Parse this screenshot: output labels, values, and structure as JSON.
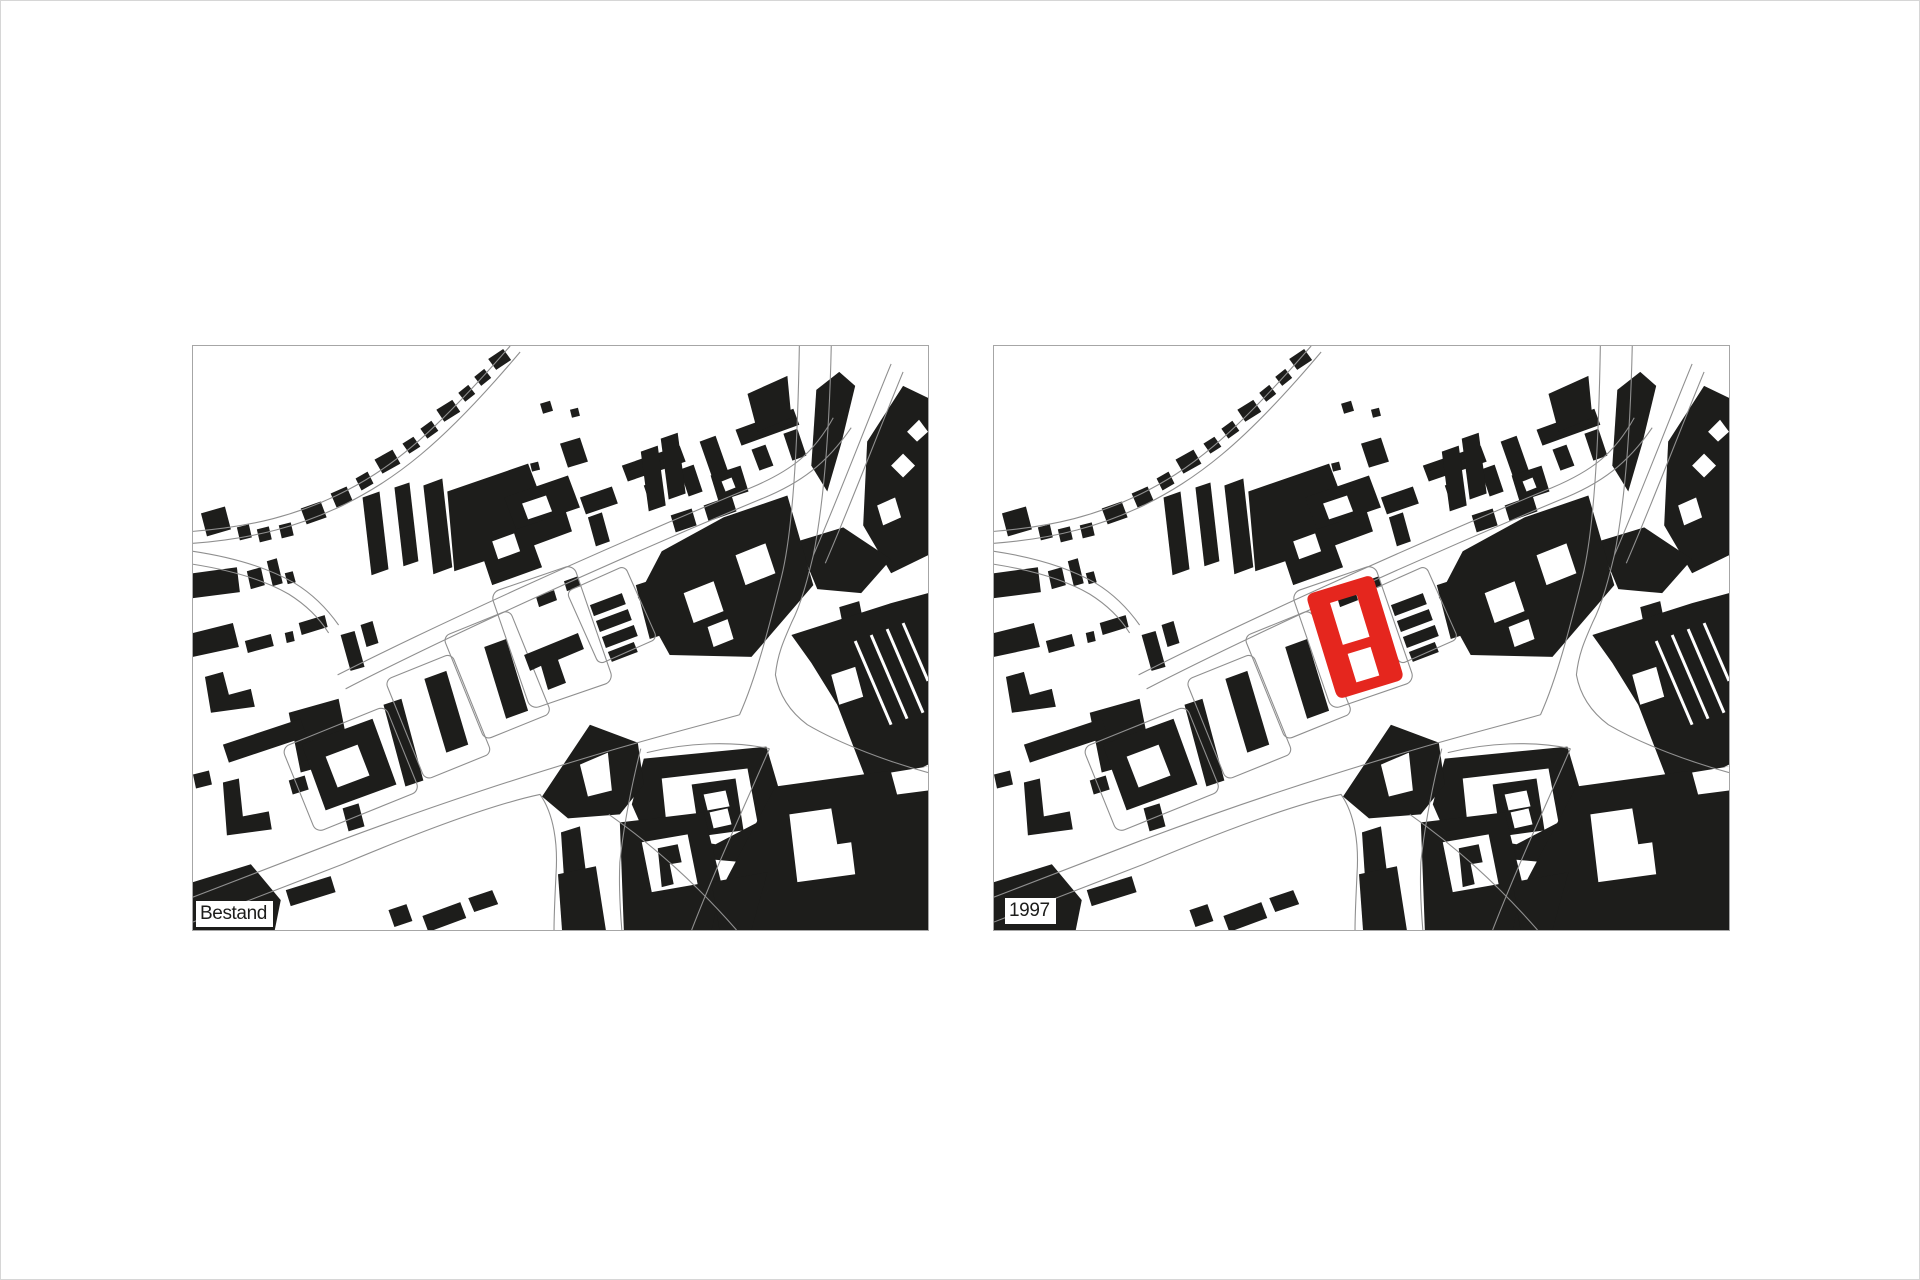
{
  "figure": {
    "description_labels": [
      "Bestand",
      "1997"
    ]
  },
  "colors": {
    "building_black": "#1d1d1b",
    "street_line": "#8f8f8f",
    "panel_border": "#a6a6a6",
    "page_border": "#d6d6d6",
    "highlight_red": "#e5261e",
    "label_text": "#1d1d1b",
    "label_bg": "#ffffff"
  },
  "panels": [
    {
      "id": "bestand",
      "label": "Bestand",
      "highlight_building": false
    },
    {
      "id": "1997",
      "label": "1997",
      "highlight_building": true
    }
  ]
}
